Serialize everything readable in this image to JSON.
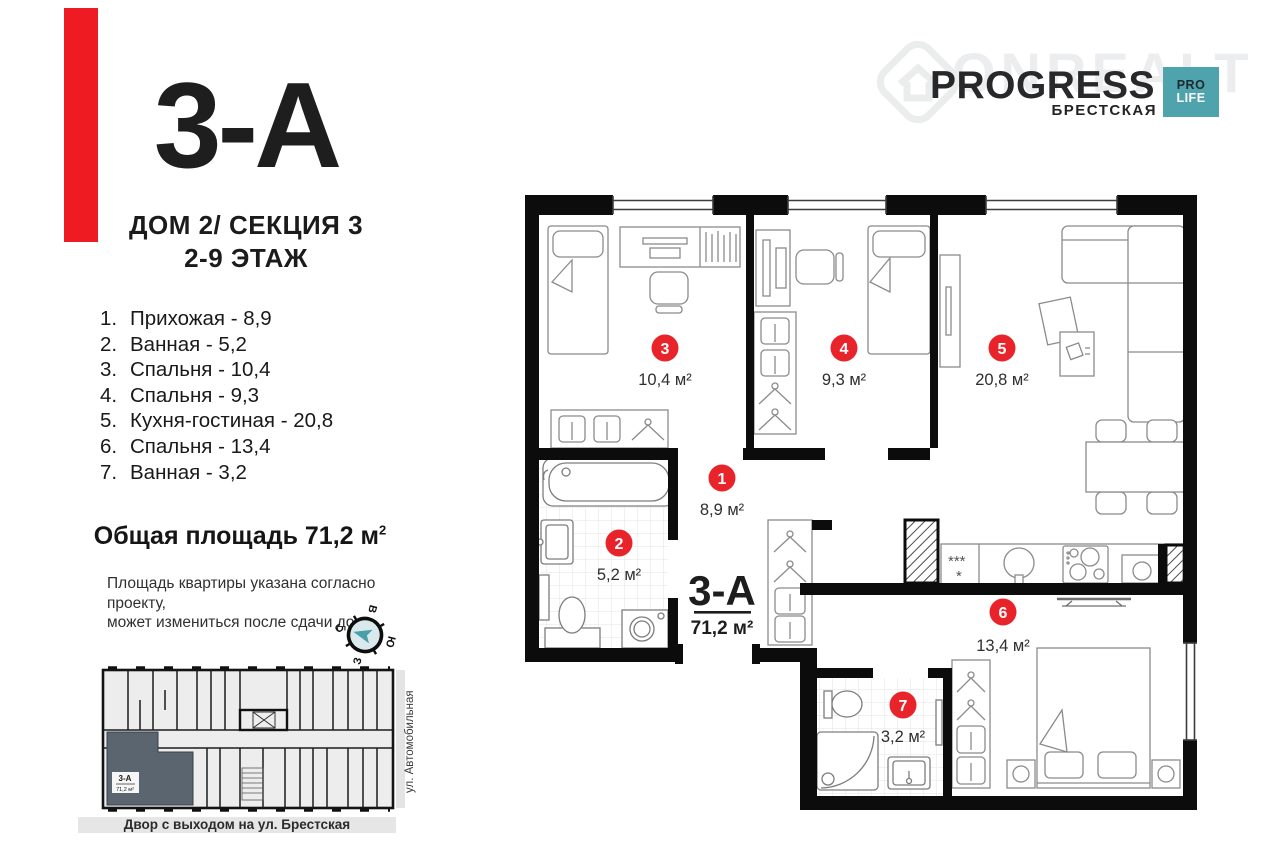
{
  "header": {
    "unit": "3-А",
    "building_line": "ДОМ 2/ СЕКЦИЯ 3",
    "floors_line": "2-9 ЭТАЖ"
  },
  "room_list": [
    {
      "num": "1.",
      "label": "Прихожая - 8,9"
    },
    {
      "num": "2.",
      "label": "Ванная - 5,2"
    },
    {
      "num": "3.",
      "label": "Спальня - 10,4"
    },
    {
      "num": "4.",
      "label": "Спальня - 9,3"
    },
    {
      "num": "5.",
      "label": "Кухня-гостиная - 20,8"
    },
    {
      "num": "6.",
      "label": "Спальня - 13,4"
    },
    {
      "num": "7.",
      "label": "Ванная - 3,2"
    }
  ],
  "total": {
    "text": "Общая площадь 71,2 м",
    "sup": "2"
  },
  "disclaimer": {
    "line1": "Площадь квартиры указана согласно проекту,",
    "line2": "может измениться после сдачи дома"
  },
  "brand": {
    "name": "PROGRESS",
    "district": "БРЕСТСКАЯ",
    "badge_top": "PRO",
    "badge_bottom": "LIFE",
    "watermark": "ONREALT",
    "badge_color": "#4fa3ac",
    "accent_red": "#ee1b22"
  },
  "compass": {
    "top": "В",
    "right": "Ю",
    "bottom": "З",
    "left": "С"
  },
  "plan": {
    "unit_label": "3-А",
    "unit_area": "71,2 м²",
    "rooms": [
      {
        "num": "1",
        "area": "8,9 м²"
      },
      {
        "num": "2",
        "area": "5,2 м²"
      },
      {
        "num": "3",
        "area": "10,4 м²"
      },
      {
        "num": "4",
        "area": "9,3 м²"
      },
      {
        "num": "5",
        "area": "20,8 м²"
      },
      {
        "num": "6",
        "area": "13,4 м²"
      },
      {
        "num": "7",
        "area": "3,2 м²"
      }
    ]
  },
  "minimap": {
    "unit_label": "3-А",
    "unit_area": "71,2 м²",
    "street_side": "ул. Автомобильная",
    "street_bottom": "Двор с выходом на ул. Брестская"
  }
}
